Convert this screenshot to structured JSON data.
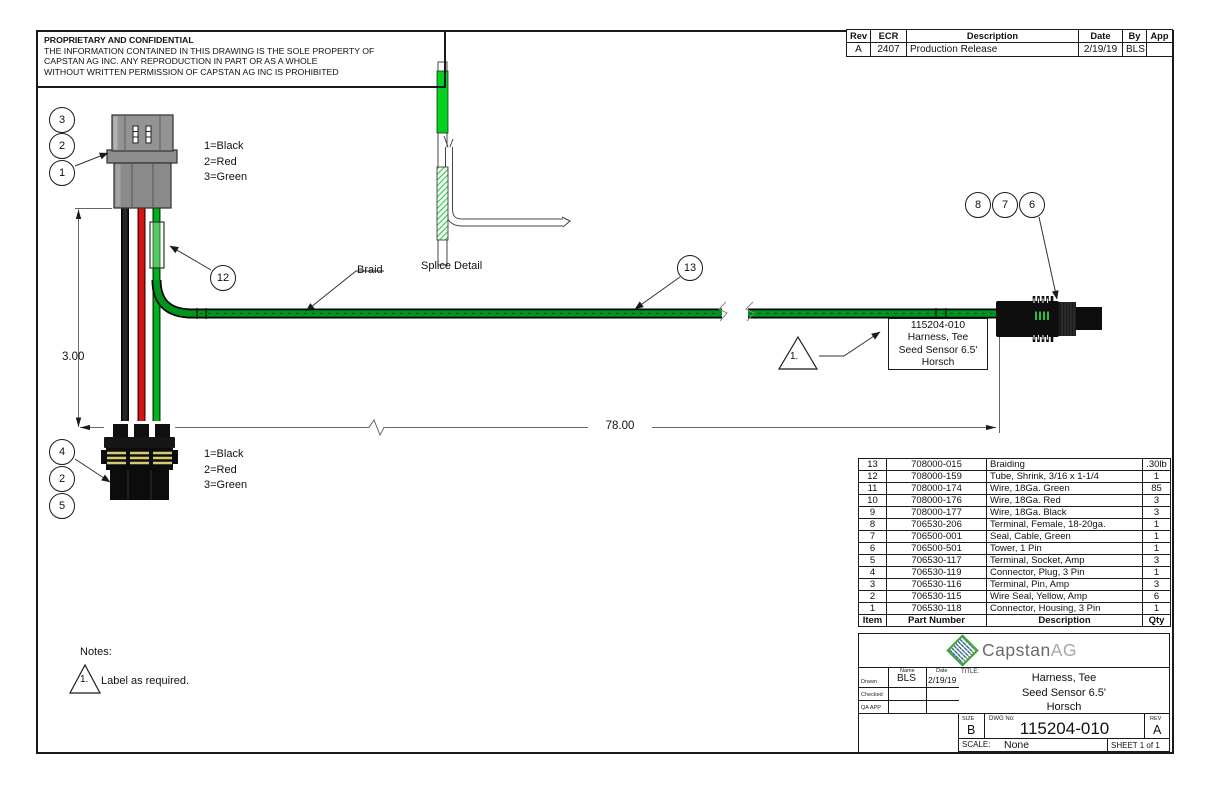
{
  "proprietary": {
    "title": "PROPRIETARY AND CONFIDENTIAL",
    "lines": [
      "THE INFORMATION CONTAINED IN THIS DRAWING IS THE SOLE PROPERTY OF",
      "CAPSTAN AG INC. ANY REPRODUCTION IN PART OR AS A WHOLE",
      "WITHOUT WRITTEN PERMISSION OF CAPSTAN AG INC IS PROHIBITED"
    ]
  },
  "revision_table": {
    "headers": [
      "Rev",
      "ECR",
      "Description",
      "Date",
      "By",
      "App"
    ],
    "row": {
      "rev": "A",
      "ecr": "2407",
      "description": "Production Release",
      "date": "2/19/19",
      "by": "BLS",
      "app": ""
    }
  },
  "balloons": {
    "b1": "1",
    "b2": "2",
    "b3": "3",
    "b4": "4",
    "b5": "5",
    "b6": "6",
    "b7": "7",
    "b8": "8",
    "b12": "12",
    "b13": "13",
    "b2_bottom": "2"
  },
  "legend_top": [
    "1=Black",
    "2=Red",
    "3=Green"
  ],
  "legend_bottom": [
    "1=Black",
    "2=Red",
    "3=Green"
  ],
  "labels": {
    "braid": "Braid",
    "splice": "Splice Detail"
  },
  "dims": {
    "height": "3.00",
    "length": "78.00"
  },
  "callout": {
    "l1": "115204-010",
    "l2": "Harness, Tee",
    "l3": "Seed Sensor 6.5'",
    "l4": "Horsch"
  },
  "flag": {
    "number": "1."
  },
  "notes": {
    "title": "Notes:",
    "flag": "1.",
    "text": "Label as required."
  },
  "bom": {
    "headers": [
      "Item",
      "Part Number",
      "Description",
      "Qty"
    ],
    "rows": [
      [
        "13",
        "708000-015",
        "Braiding",
        ".30lb"
      ],
      [
        "12",
        "708000-159",
        "Tube, Shrink, 3/16 x 1-1/4",
        "1"
      ],
      [
        "11",
        "708000-174",
        "Wire, 18Ga. Green",
        "85"
      ],
      [
        "10",
        "708000-176",
        "Wire, 18Ga. Red",
        "3"
      ],
      [
        "9",
        "708000-177",
        "Wire, 18Ga. Black",
        "3"
      ],
      [
        "8",
        "706530-206",
        "Terminal, Female, 18-20ga.",
        "1"
      ],
      [
        "7",
        "706500-001",
        "Seal, Cable, Green",
        "1"
      ],
      [
        "6",
        "706500-501",
        "Tower, 1 Pin",
        "1"
      ],
      [
        "5",
        "706530-117",
        "Terminal, Socket, Amp",
        "3"
      ],
      [
        "4",
        "706530-119",
        "Connector, Plug, 3 Pin",
        "1"
      ],
      [
        "3",
        "706530-116",
        "Terminal, Pin, Amp",
        "3"
      ],
      [
        "2",
        "706530-115",
        "Wire Seal, Yellow, Amp",
        "6"
      ],
      [
        "1",
        "706530-118",
        "Connector, Housing, 3 Pin",
        "1"
      ]
    ]
  },
  "title_block": {
    "logo_part1": "Capstan",
    "logo_part2": "AG",
    "drawn_label": "Drawn",
    "checked_label": "Checked",
    "qa_label": "QA APP",
    "name_label": "Name",
    "date_label": "Date",
    "drawn_name": "BLS",
    "drawn_date": "2/19/19",
    "title_label": "TITLE:",
    "title1": "Harness, Tee",
    "title2": "Seed Sensor 6.5'",
    "title3": "Horsch",
    "size_label": "SIZE",
    "size": "B",
    "dwg_label": "DWG No:",
    "dwg_no": "115204-010",
    "rev_label": "REV",
    "rev": "A",
    "scale_label": "SCALE:",
    "scale": "None",
    "sheet": "SHEET 1 of 1"
  },
  "colors": {
    "wire_green": "#00b31e",
    "wire_red": "#d41414",
    "wire_black": "#1a1a1a",
    "braid_green": "#00961e",
    "seal_yellow": "#d6ca72",
    "logo_green": "#3fa535",
    "logo_blue": "#3a66ad"
  }
}
